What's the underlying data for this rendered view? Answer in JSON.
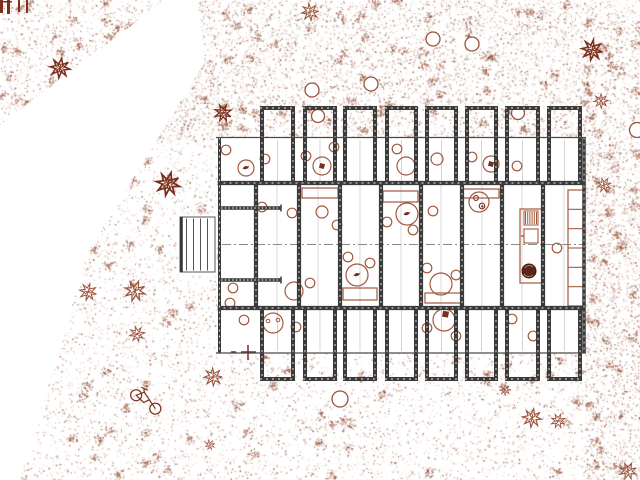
{
  "title": "site-floor-plan-drawing",
  "colors": {
    "paper": "#ffffff",
    "terrain_palette": [
      "#9a523a",
      "#8a462f",
      "#aa6b50",
      "#7e3a26",
      "#c09579"
    ],
    "furniture": "#a3583c",
    "accent_dark": "#7c2f1d",
    "wall_dark": "#3a3a3a",
    "wall_thin": "#4a4a4a",
    "grid_gray": "#bbbbbb",
    "centerline_gray": "#8a8a8a",
    "pot_fill": "#5c2517"
  },
  "stipple": {
    "main_polygon": [
      [
        198,
        0
      ],
      [
        640,
        0
      ],
      [
        640,
        480
      ],
      [
        20,
        480
      ],
      [
        88,
        252
      ],
      [
        205,
        62
      ]
    ],
    "region_a": [
      [
        0,
        0
      ],
      [
        165,
        0
      ],
      [
        0,
        125
      ]
    ],
    "holes": [
      [
        217,
        137,
        368,
        216
      ],
      [
        178,
        215,
        40,
        61
      ]
    ],
    "zones": [
      {
        "name": "top-band",
        "rect": [
          88,
          0,
          552,
          140
        ],
        "dots": 9000,
        "clusters": 90,
        "seed": 11
      },
      {
        "name": "right-upper",
        "rect": [
          585,
          140,
          55,
          115
        ],
        "dots": 950,
        "clusters": 12,
        "seed": 22
      },
      {
        "name": "right-lower",
        "rect": [
          585,
          255,
          55,
          225
        ],
        "dots": 1650,
        "clusters": 18,
        "seed": 33
      },
      {
        "name": "bottom",
        "rect": [
          20,
          353,
          566,
          127
        ],
        "dots": 4300,
        "clusters": 46,
        "seed": 44
      },
      {
        "name": "left-strip",
        "rect": [
          60,
          58,
          158,
          296
        ],
        "dots": 2700,
        "clusters": 30,
        "seed": 55
      },
      {
        "name": "corner-a",
        "rect": [
          0,
          0,
          168,
          128
        ],
        "dots": 1700,
        "clusters": 26,
        "seed": 66,
        "clip": "A"
      }
    ]
  },
  "nature": {
    "trees": [
      [
        312,
        90,
        7
      ],
      [
        371,
        84,
        7
      ],
      [
        433,
        39,
        7
      ],
      [
        472,
        44,
        7
      ],
      [
        318,
        116,
        6.5
      ],
      [
        518,
        113,
        6.5
      ],
      [
        637,
        130,
        7.5
      ],
      [
        340,
        399,
        8
      ]
    ],
    "plants": [
      {
        "x": 60,
        "y": 68,
        "s": 1.1,
        "rot": 10,
        "dark": true
      },
      {
        "x": 310,
        "y": 12,
        "s": 0.95,
        "rot": 40,
        "dark": false
      },
      {
        "x": 223,
        "y": 113,
        "s": 0.95,
        "rot": 70,
        "dark": true
      },
      {
        "x": 168,
        "y": 184,
        "s": 1.3,
        "rot": 15,
        "dark": true
      },
      {
        "x": 592,
        "y": 50,
        "s": 1.15,
        "rot": 55,
        "dark": true
      },
      {
        "x": 601,
        "y": 101,
        "s": 0.8,
        "rot": 0,
        "dark": false
      },
      {
        "x": 604,
        "y": 185,
        "s": 0.8,
        "rot": 30,
        "dark": false
      },
      {
        "x": 88,
        "y": 292,
        "s": 0.95,
        "rot": 60,
        "dark": false
      },
      {
        "x": 135,
        "y": 291,
        "s": 1.15,
        "rot": 20,
        "dark": false
      },
      {
        "x": 137,
        "y": 334,
        "s": 0.85,
        "rot": 80,
        "dark": false
      },
      {
        "x": 213,
        "y": 377,
        "s": 1.0,
        "rot": 45,
        "dark": false
      },
      {
        "x": 532,
        "y": 418,
        "s": 1.05,
        "rot": 10,
        "dark": false
      },
      {
        "x": 558,
        "y": 421,
        "s": 0.8,
        "rot": 70,
        "dark": false
      },
      {
        "x": 628,
        "y": 471,
        "s": 0.95,
        "rot": 25,
        "dark": false
      },
      {
        "x": 505,
        "y": 390,
        "s": 0.6,
        "rot": 0,
        "dark": false
      },
      {
        "x": 210,
        "y": 445,
        "s": 0.55,
        "rot": 30,
        "dark": false
      }
    ],
    "bicycle": {
      "x": 146,
      "y": 401,
      "rot": 15
    },
    "corner_bars": [
      [
        0,
        0,
        3,
        13
      ],
      [
        7,
        0,
        3,
        14
      ],
      [
        18,
        0,
        2,
        12
      ],
      [
        26,
        0,
        2,
        13
      ],
      [
        0,
        1,
        12,
        1.5
      ]
    ],
    "cross_marker": {
      "x": 248,
      "y": 352
    }
  },
  "plan": {
    "outline": {
      "x1": 217,
      "x2": 585,
      "y_top": 137.5,
      "y_bottom": 353
    },
    "bays_x": [
      [
        260,
        295
      ],
      [
        303,
        337
      ],
      [
        343,
        377
      ],
      [
        385,
        418
      ],
      [
        425,
        458
      ],
      [
        465,
        498
      ],
      [
        505,
        540
      ],
      [
        547,
        582
      ]
    ],
    "top_bays": {
      "y_roof": 108,
      "y_start": 106,
      "y_end": 183
    },
    "bottom_bays": {
      "y_start": 308,
      "y_end": 380.5,
      "y_floor": 379
    },
    "mid_walls_x": [
      256,
      299,
      340,
      381,
      421,
      462,
      502,
      543
    ],
    "mid_band": {
      "y1": 183,
      "y2": 308
    },
    "centerline_y": 244.5,
    "mid_room_centers_x": [
      277,
      318,
      360,
      401,
      441,
      482,
      522,
      564
    ],
    "hatched_walls": [
      {
        "x1": 221,
        "x2": 281,
        "y": 208
      },
      {
        "x1": 221,
        "x2": 281,
        "y": 280
      }
    ],
    "deck": {
      "x": 180,
      "y": 217,
      "w": 35,
      "h": 55,
      "planks_x": [
        186.5,
        193.5,
        200.5,
        207.5
      ]
    }
  },
  "furniture": {
    "tables": [
      {
        "x": 246,
        "y": 168,
        "r": 8,
        "mark": "bird"
      },
      {
        "x": 322,
        "y": 166,
        "r": 9,
        "mark": "box"
      },
      {
        "x": 406,
        "y": 166,
        "r": 9,
        "mark": ""
      },
      {
        "x": 491,
        "y": 164,
        "r": 8,
        "mark": "box"
      },
      {
        "x": 437,
        "y": 159,
        "r": 6,
        "mark": ""
      },
      {
        "x": 357,
        "y": 275,
        "r": 11,
        "mark": "bird"
      },
      {
        "x": 407,
        "y": 214,
        "r": 11,
        "mark": "bird"
      },
      {
        "x": 479,
        "y": 202,
        "r": 10,
        "mark": "cups"
      },
      {
        "x": 441,
        "y": 284,
        "r": 11,
        "mark": ""
      },
      {
        "x": 294,
        "y": 291,
        "r": 9,
        "mark": ""
      },
      {
        "x": 273,
        "y": 323,
        "r": 10,
        "mark": "dots"
      },
      {
        "x": 444,
        "y": 320,
        "r": 11,
        "mark": "boxdark"
      },
      {
        "x": 322,
        "y": 212,
        "r": 6,
        "mark": ""
      }
    ],
    "chairs": [
      [
        226,
        150
      ],
      [
        265,
        159
      ],
      [
        306,
        156
      ],
      [
        334,
        147
      ],
      [
        397,
        149
      ],
      [
        472,
        157
      ],
      [
        517,
        166
      ],
      [
        262,
        207
      ],
      [
        292,
        213
      ],
      [
        337,
        225
      ],
      [
        348,
        257
      ],
      [
        370,
        263
      ],
      [
        387,
        222
      ],
      [
        413,
        230
      ],
      [
        433,
        211
      ],
      [
        427,
        268
      ],
      [
        456,
        275
      ],
      [
        557,
        248
      ],
      [
        310,
        283
      ],
      [
        233,
        288
      ],
      [
        244,
        320
      ],
      [
        296,
        327
      ],
      [
        427,
        328
      ],
      [
        512,
        319
      ],
      [
        533,
        336
      ],
      [
        456,
        336
      ],
      [
        230,
        303
      ]
    ],
    "beds": [
      [
        302,
        188,
        36,
        10
      ],
      [
        383,
        191,
        35,
        11
      ],
      [
        463,
        189,
        36,
        9
      ],
      [
        343,
        288,
        34,
        12
      ],
      [
        425,
        293,
        37,
        10
      ]
    ],
    "kitchen": {
      "x": 520,
      "y": 209,
      "w": 22,
      "h": 74
    },
    "shelf": {
      "x": 568,
      "y": 190,
      "w": 16,
      "h": 116,
      "cells": 6
    },
    "plant_pot": {
      "x": 529,
      "y": 271,
      "r": 7
    }
  }
}
